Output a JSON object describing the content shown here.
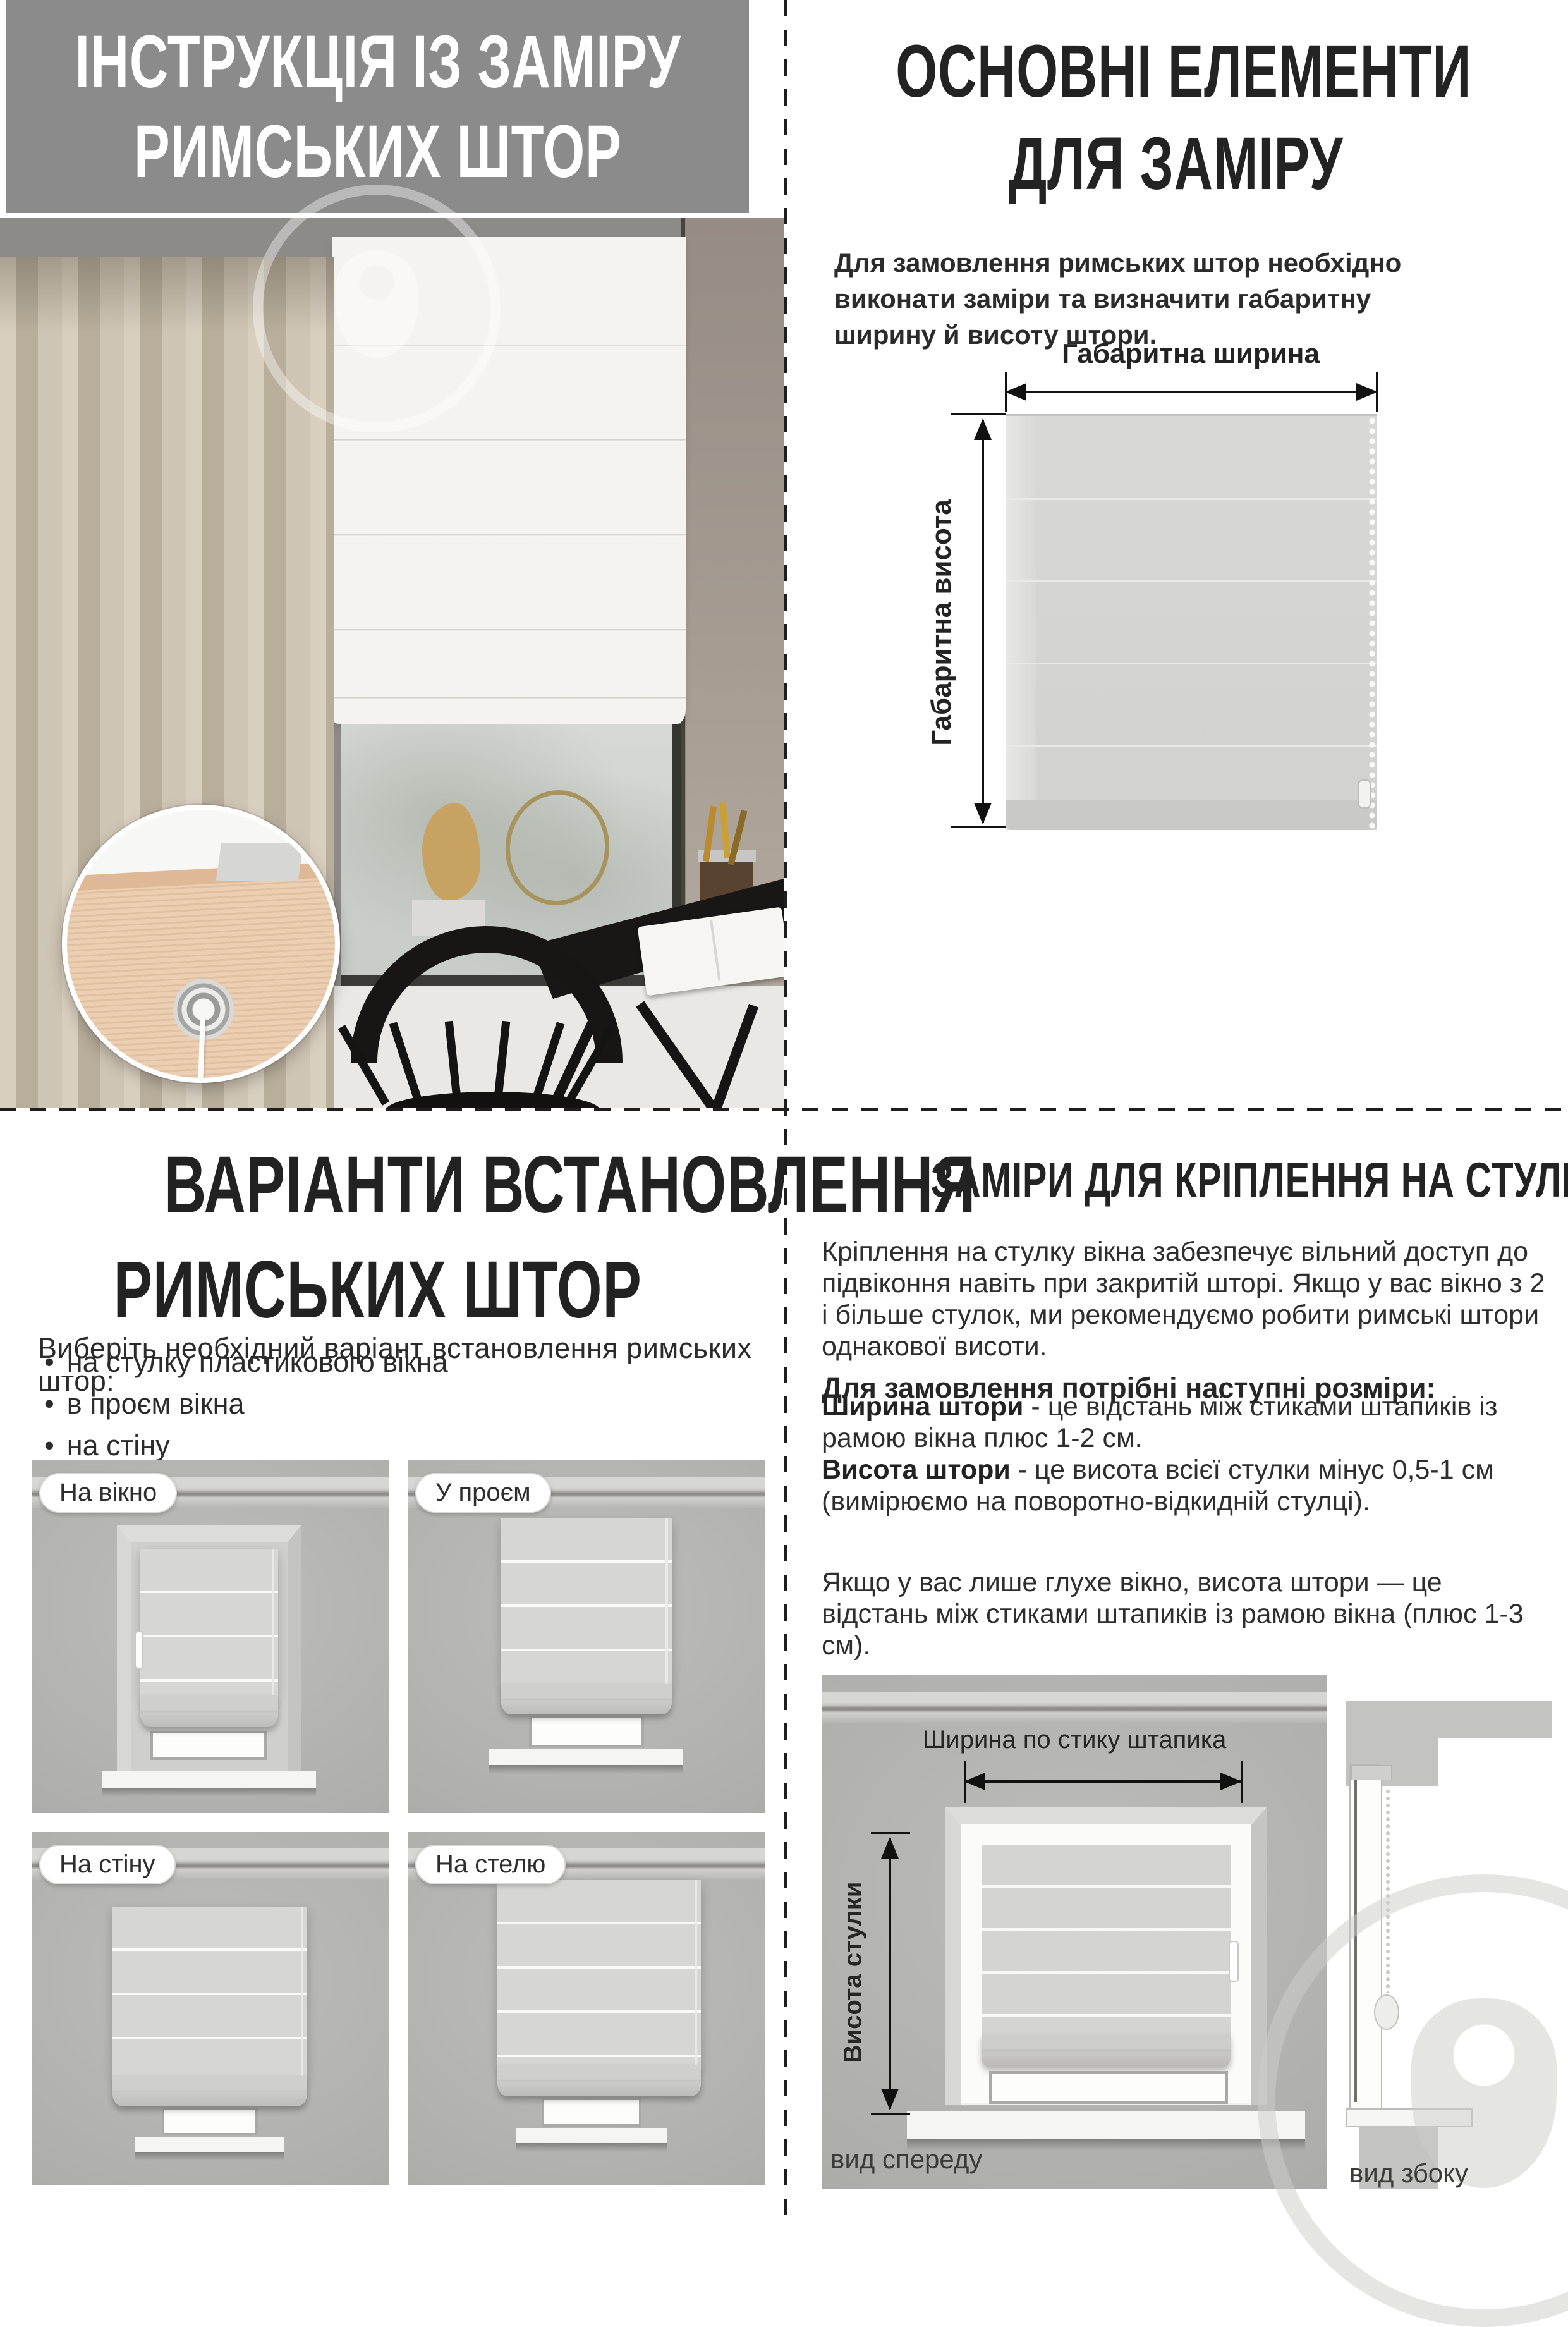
{
  "page": {
    "top_left": {
      "title_line1": "ІНСТРУКЦІЯ ІЗ ЗАМІРУ",
      "title_line2": "РИМСЬКИХ ШТОР"
    },
    "top_right": {
      "title_line1": "ОСНОВНІ ЕЛЕМЕНТИ",
      "title_line2": "ДЛЯ ЗАМІРУ",
      "intro": "Для замовлення римських штор необхідно виконати заміри та визначити габаритну ширину й висоту штори.",
      "diagram": {
        "width_label": "Габаритна ширина",
        "height_label": "Габаритна висота"
      }
    },
    "bottom_left": {
      "title_line1": "ВАРІАНТИ ВСТАНОВЛЕННЯ",
      "title_line2": "РИМСЬКИХ ШТОР",
      "subtitle": "Виберіть необхідний варіант встановлення римських штор:",
      "bullet_char": "•",
      "bullets": [
        "на стулку пластикового вікна",
        "в проєм вікна",
        "на стіну",
        "на стелю"
      ],
      "variant_labels": [
        "На вікно",
        "У проєм",
        "На стіну",
        "На стелю"
      ]
    },
    "bottom_right": {
      "title": "ЗАМІРИ ДЛЯ КРІПЛЕННЯ НА СТУЛКУ ВІКНА",
      "paragraph": "Кріплення на стулку вікна забезпечує вільний доступ до підвіконня навіть при закритій шторі. Якщо у вас вікно з 2 і більше стулок, ми рекомендуємо робити римські штори однакової висоти.",
      "sizes_heading": "Для замовлення потрібні наступні розміри:",
      "width_term": "Ширина штори",
      "width_def": " - це відстань між стиками штапиків із рамою вікна плюс 1-2 см.",
      "height_term": "Висота штори",
      "height_def": " - це висота всієї стулки мінус 0,5-1 см (вимірюємо на поворотно-відкидній стулці).",
      "note": "Якщо у вас лише глухе вікно, висота штори — це відстань між стиками штапиків із рамою вікна (плюс 1-3 см).",
      "diagram": {
        "width_label": "Ширина по стику штапика",
        "height_label": "Висота стулки",
        "front_caption": "вид спереду",
        "side_caption": "вид збоку"
      }
    },
    "colors": {
      "header_gray": "#8b8b8b",
      "text_black": "#232323",
      "blind_gray": "#d4d4d2",
      "wall_gray": "#adadab"
    }
  }
}
